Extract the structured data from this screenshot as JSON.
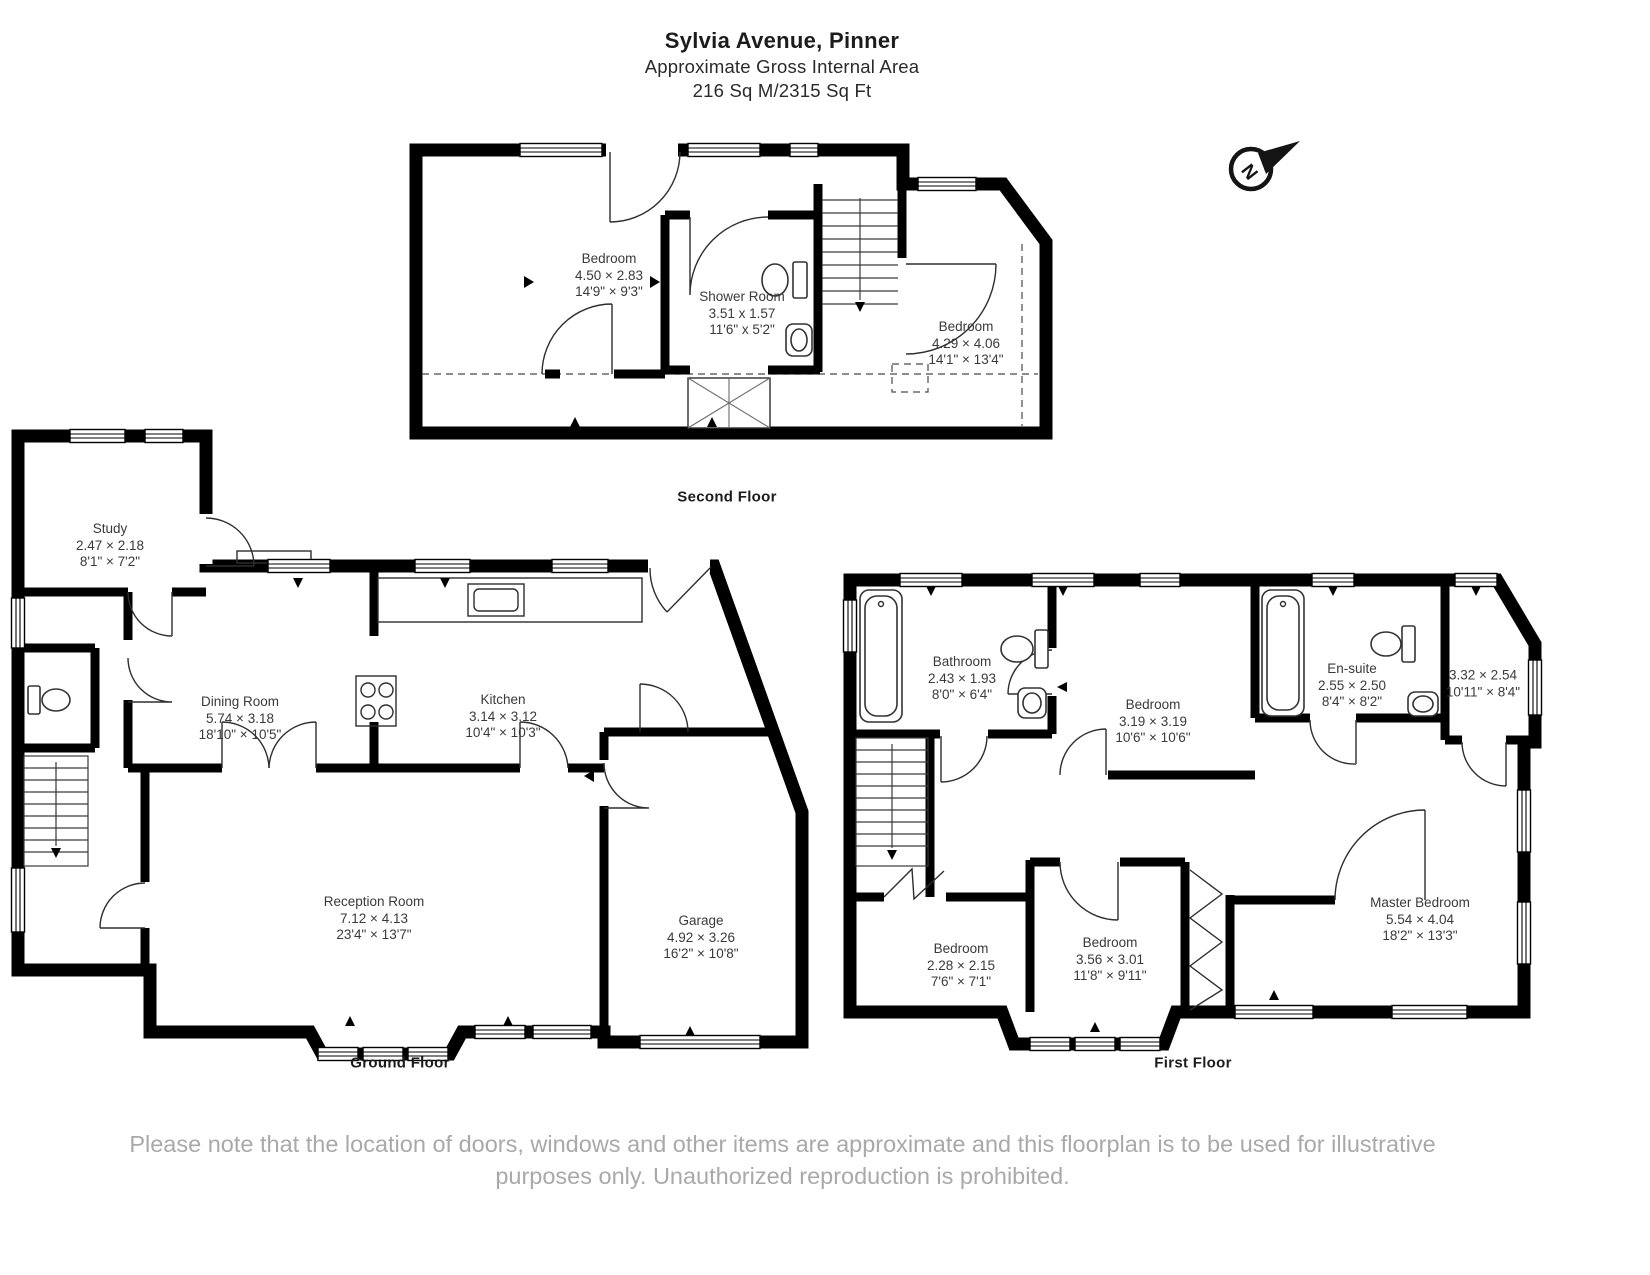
{
  "header": {
    "title": "Sylvia Avenue, Pinner",
    "subtitle": "Approximate Gross Internal Area",
    "area": "216 Sq M/2315 Sq Ft"
  },
  "compass": {
    "letter": "N"
  },
  "floors": [
    {
      "label": "Second Floor",
      "rooms": [
        {
          "name": "Bedroom",
          "metric": "4.50 × 2.83",
          "imperial": "14'9\" × 9'3\""
        },
        {
          "name": "Shower Room",
          "metric": "3.51 x 1.57",
          "imperial": "11'6\" x 5'2\""
        },
        {
          "name": "Bedroom",
          "metric": "4.29 × 4.06",
          "imperial": "14'1\" × 13'4\""
        }
      ]
    },
    {
      "label": "Ground Floor",
      "rooms": [
        {
          "name": "Study",
          "metric": "2.47 × 2.18",
          "imperial": "8'1\" × 7'2\""
        },
        {
          "name": "Dining Room",
          "metric": "5.74 × 3.18",
          "imperial": "18'10\" × 10'5\""
        },
        {
          "name": "Kitchen",
          "metric": "3.14 × 3.12",
          "imperial": "10'4\" × 10'3\""
        },
        {
          "name": "Reception Room",
          "metric": "7.12 × 4.13",
          "imperial": "23'4\" × 13'7\""
        },
        {
          "name": "Garage",
          "metric": "4.92 × 3.26",
          "imperial": "16'2\" × 10'8\""
        }
      ]
    },
    {
      "label": "First Floor",
      "rooms": [
        {
          "name": "Bathroom",
          "metric": "2.43 × 1.93",
          "imperial": "8'0\" × 6'4\""
        },
        {
          "name": "Bedroom",
          "metric": "3.19 × 3.19",
          "imperial": "10'6\" × 10'6\""
        },
        {
          "name": "En-suite",
          "metric": "2.55 × 2.50",
          "imperial": "8'4\" × 8'2\""
        },
        {
          "name": "",
          "metric": "3.32 × 2.54",
          "imperial": "10'11\" × 8'4\""
        },
        {
          "name": "Master Bedroom",
          "metric": "5.54 × 4.04",
          "imperial": "18'2\" × 13'3\""
        },
        {
          "name": "Bedroom",
          "metric": "2.28 × 2.15",
          "imperial": "7'6\" × 7'1\""
        },
        {
          "name": "Bedroom",
          "metric": "3.56 × 3.01",
          "imperial": "11'8\" × 9'11\""
        }
      ]
    }
  ],
  "footer": {
    "disclaimer": "Please note that the location of doors, windows and other items are approximate and this floorplan is to be used for illustrative purposes only. Unauthorized reproduction is prohibited."
  }
}
